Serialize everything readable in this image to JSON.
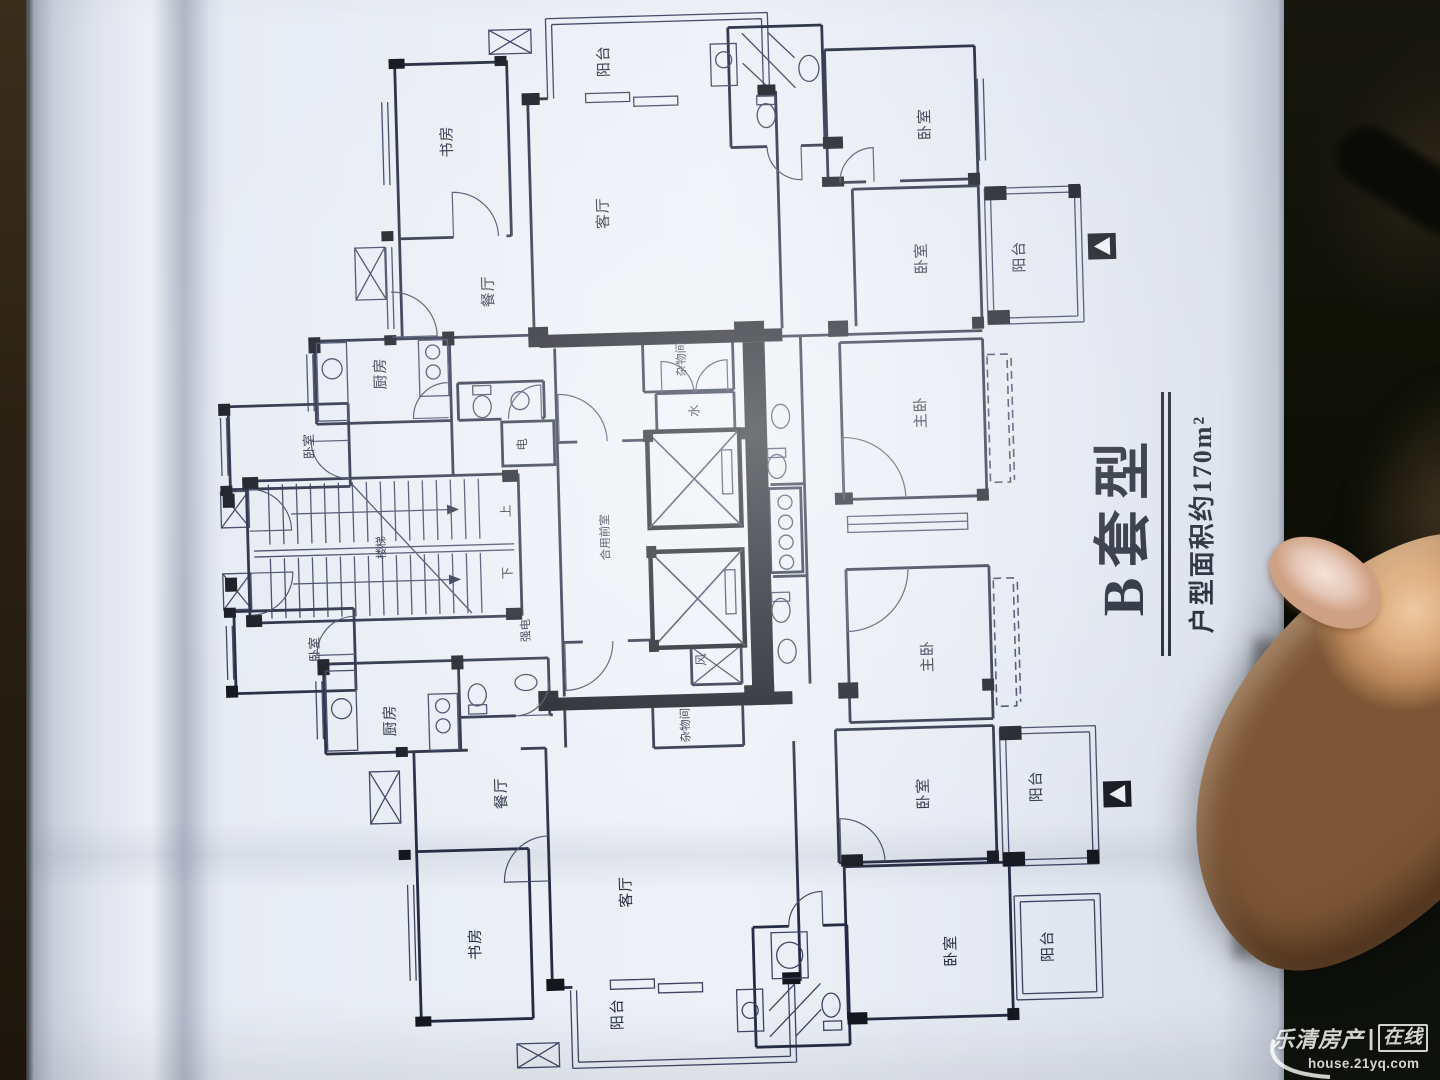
{
  "photo": {
    "title": "B套型",
    "subtitle": "户型面积约170m²",
    "watermark": {
      "brand": "乐清房产",
      "separator": "|",
      "boxed": "在线",
      "url": "house.21yq.com"
    },
    "colors": {
      "paper": "#e9edf4",
      "ink": "#2b3148",
      "wall": "#15171f",
      "skin": "#dcab7e",
      "background": "#0e100b"
    }
  },
  "plan": {
    "unit_label": "B套型",
    "area_note": "户型面积约170m²",
    "labels": [
      {
        "id": "balcony-top",
        "text": "阳台"
      },
      {
        "id": "study-top",
        "text": "书房"
      },
      {
        "id": "living-top",
        "text": "客厅"
      },
      {
        "id": "dining-top",
        "text": "餐厅"
      },
      {
        "id": "kitchen-top",
        "text": "厨房"
      },
      {
        "id": "bedroom-left-top",
        "text": "卧室"
      },
      {
        "id": "elec-meter-top",
        "text": "电"
      },
      {
        "id": "storage-top",
        "text": "杂物间"
      },
      {
        "id": "water-meter",
        "text": "水"
      },
      {
        "id": "bedroom-right-1",
        "text": "卧室"
      },
      {
        "id": "bedroom-right-2",
        "text": "卧室"
      },
      {
        "id": "balcony-right-top",
        "text": "阳台"
      },
      {
        "id": "master-top",
        "text": "主卧"
      },
      {
        "id": "stairs",
        "text": "楼梯"
      },
      {
        "id": "stairs-up",
        "text": "上"
      },
      {
        "id": "stairs-down",
        "text": "下"
      },
      {
        "id": "shared-lobby",
        "text": "合用前室"
      },
      {
        "id": "strong-elec",
        "text": "强电"
      },
      {
        "id": "vent-shaft",
        "text": "风"
      },
      {
        "id": "master-bottom",
        "text": "主卧"
      },
      {
        "id": "bedroom-left-bot",
        "text": "卧室"
      },
      {
        "id": "kitchen-bottom",
        "text": "厨房"
      },
      {
        "id": "storage-bottom",
        "text": "杂物间"
      },
      {
        "id": "dining-bottom",
        "text": "餐厅"
      },
      {
        "id": "bedroom-right-3",
        "text": "卧室"
      },
      {
        "id": "balcony-right-bot",
        "text": "阳台"
      },
      {
        "id": "study-bottom",
        "text": "书房"
      },
      {
        "id": "living-bottom",
        "text": "客厅"
      },
      {
        "id": "bedroom-right-4",
        "text": "卧室"
      },
      {
        "id": "balcony-br",
        "text": "阳台"
      },
      {
        "id": "balcony-bottom",
        "text": "阳台"
      }
    ]
  }
}
